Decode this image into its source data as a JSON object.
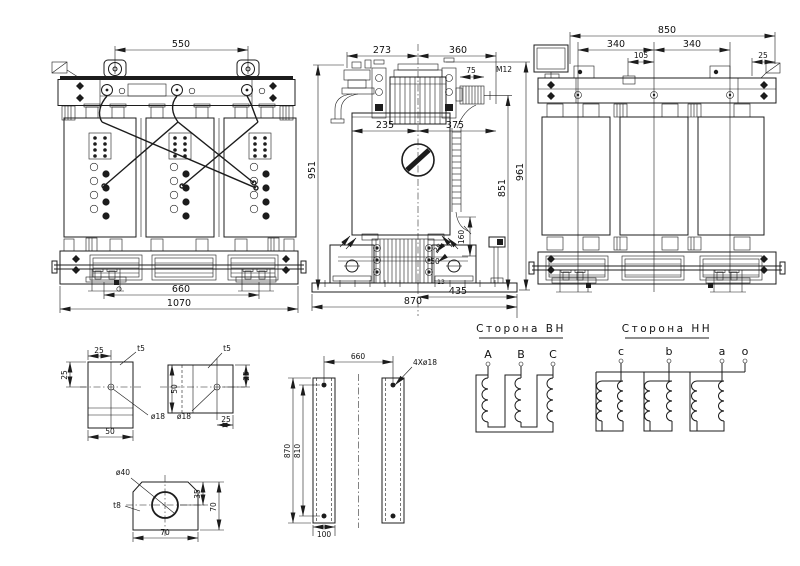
{
  "front_view": {
    "dim_550": "550",
    "dim_660": "660",
    "dim_1070": "1070"
  },
  "side_view": {
    "dim_273": "273",
    "dim_360": "360",
    "dim_75": "75",
    "thread": "M12",
    "dim_235": "235",
    "dim_375": "375",
    "dim_951": "951",
    "dim_961": "961",
    "dim_851": "851",
    "dim_160": "160",
    "dim_25": "25",
    "dim_50": "50",
    "dim_13": "13",
    "dim_435": "435",
    "dim_870": "870"
  },
  "rear_view": {
    "dim_850": "850",
    "dim_340_left": "340",
    "dim_105": "105",
    "dim_340_right": "340",
    "dim_25": "25"
  },
  "details": {
    "plate_a": {
      "dim_25_top": "25",
      "dim_25_left": "25",
      "thickness": "t5",
      "hole": "ø18",
      "dim_50": "50"
    },
    "plate_b": {
      "thickness": "t5",
      "dim_50": "50",
      "dim_25_right": "25",
      "hole": "ø18",
      "dim_25_bottom": "25"
    },
    "plate_c": {
      "hole": "ø40",
      "thickness": "t8",
      "dim_70_bottom": "70",
      "dim_35": "35",
      "dim_70_right": "70"
    },
    "rails": {
      "dim_660": "660",
      "holes_note": "4Xø18",
      "dim_870": "870",
      "dim_810": "810",
      "dim_100": "100"
    }
  },
  "hv_diagram": {
    "title": "Сторона ВН",
    "terminals": [
      "A",
      "B",
      "C"
    ]
  },
  "lv_diagram": {
    "title": "Сторона НН",
    "terminals": [
      "c",
      "b",
      "a",
      "o"
    ]
  }
}
